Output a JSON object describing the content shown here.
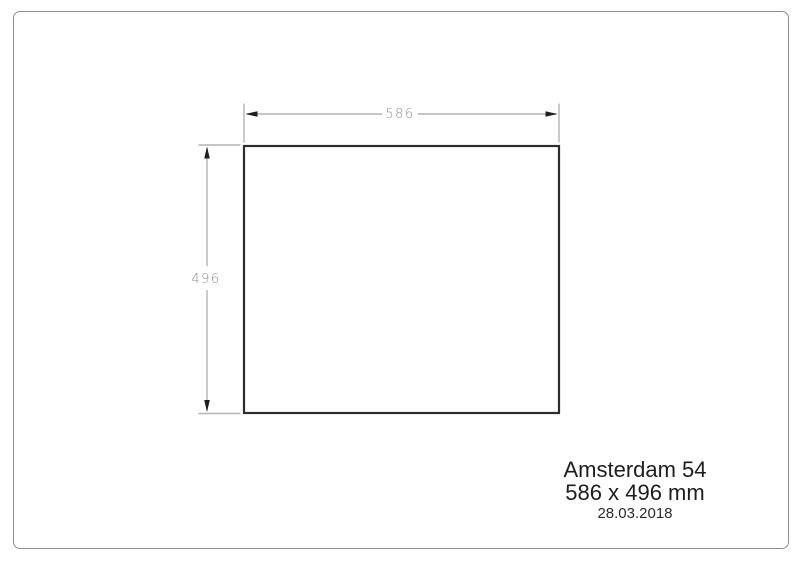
{
  "page": {
    "background_color": "#ffffff",
    "border_color": "#8e8e8e"
  },
  "drawing": {
    "product_name": "Amsterdam 54",
    "size_label": "586 x 496 mm",
    "date": "28.03.2018",
    "width_dimension": {
      "value": 586,
      "label": "586",
      "unit": "mm"
    },
    "height_dimension": {
      "value": 496,
      "label": "496",
      "unit": "mm"
    },
    "colors": {
      "outline": "#2d2d2d",
      "dimension_line": "#b4b4b4",
      "dimension_text": "#8c8c8c",
      "arrow": "#1f1f1f"
    }
  }
}
